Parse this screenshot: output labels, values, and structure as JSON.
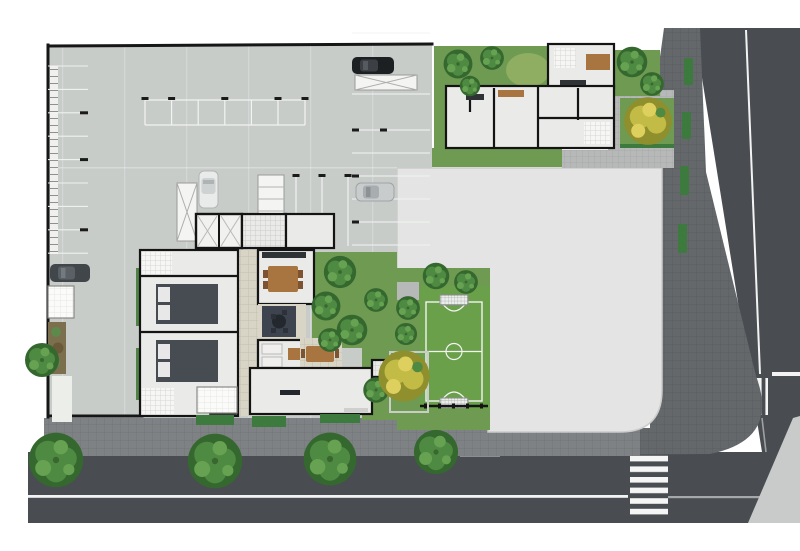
{
  "scene": {
    "kind": "architectural-site-plan",
    "description": "Color ground-floor site plan: underground-style parking slab, residential floor plan, gardens, mini soccer field, vacant corner lot, two streets with crosswalks and street trees",
    "features": [
      "parking-garage-slab",
      "parking-stall-lines",
      "storage-lockers",
      "ramp-x-boxes",
      "elevator-core",
      "car-black",
      "car-dark-gray",
      "car-white",
      "car-silver",
      "apartment-block-top-right",
      "main-building",
      "bedrooms",
      "dining-table",
      "round-table-rug",
      "sofa-set",
      "lobby",
      "entry-canopy",
      "gate-canopy",
      "driveway",
      "gardens",
      "yellow-trees",
      "street-trees",
      "hedges",
      "soccer-field",
      "goals",
      "south-fence",
      "vacant-corner-lot",
      "perimeter-sidewalk",
      "right-street",
      "bottom-street",
      "crosswalk-right-street",
      "crosswalk-bottom-street",
      "lane-markings",
      "corner-sidewalk-wedge"
    ]
  },
  "palette": {
    "paper": "#ffffff",
    "street": "#494d51",
    "band": "#64686b",
    "sidewalk": "#7e8284",
    "patio": "#b6b9b8",
    "lot": "#e3e4e3",
    "lot-edge": "#cbcccb",
    "concrete": "#c8ccc9",
    "floor": "#eaeae8",
    "wall": "#141414",
    "boundary": "#161616",
    "terrace": "#d8d5c6",
    "garden": "#6f9a52",
    "grass": "#6ba04a",
    "hedge": "#3c7a3e",
    "wood": "#a8743f",
    "bed": "#474c52",
    "rug": "#3d444f",
    "bath": "#f6f6f4",
    "tree-dark": "#35682f",
    "tree-mid": "#4e8a41",
    "tree-light": "#66a251",
    "ytree-dark": "#8f8f2d",
    "ytree-mid": "#c2bb45",
    "ytree-light": "#ddd05e",
    "car-black": "#1d2023",
    "car-gray": "#41464a",
    "car-white": "#e9eaea",
    "car-silver": "#c9cccd",
    "marking-white": "#f2f3f2",
    "wedge": "#c9cbca"
  }
}
